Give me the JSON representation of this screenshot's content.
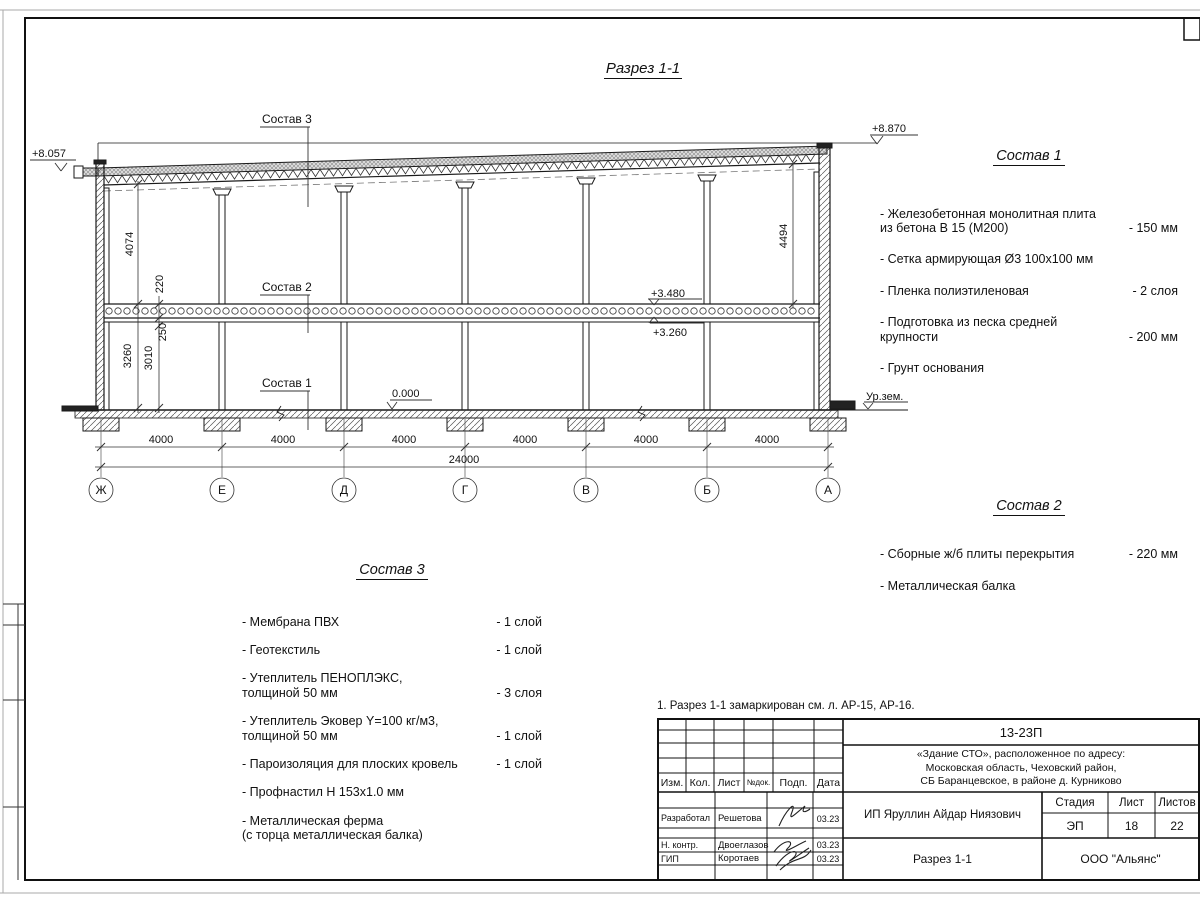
{
  "title": {
    "text": "Разрез 1-1"
  },
  "note": {
    "text": "1. Разрез 1-1 замаркирован см. л. АР-15, АР-16."
  },
  "drawing": {
    "callouts": {
      "c1": "Состав 1",
      "c2": "Состав 2",
      "c3": "Состав 3"
    },
    "elevations": {
      "left_top": "+8.057",
      "right_top": "+8.870",
      "slab_top": "+3.480",
      "slab_bottom": "+3.260",
      "floor": "0.000",
      "ground": "Ур.зем."
    },
    "dims": {
      "bays": [
        "4000",
        "4000",
        "4000",
        "4000",
        "4000",
        "4000"
      ],
      "total": "24000",
      "roof_to_slab_left": "4074",
      "slab_to_floor_left": "3260",
      "slab_thickness": "220",
      "beam_zone": "250",
      "clear_height": "3010",
      "roof_to_slab_right": "4494"
    },
    "axes": [
      "Ж",
      "Е",
      "Д",
      "Г",
      "В",
      "Б",
      "А"
    ]
  },
  "sostav1": {
    "heading": "Состав 1",
    "items": [
      {
        "name": "- Железобетонная  монолитная плита\nиз бетона В 15 (М200)",
        "qty": "- 150 мм"
      },
      {
        "name": "- Сетка армирующая Ø3 100х100 мм",
        "qty": ""
      },
      {
        "name": "- Пленка полиэтиленовая",
        "qty": "-  2 слоя"
      },
      {
        "name": "- Подготовка из песка средней\nкрупности",
        "qty": "- 200 мм"
      },
      {
        "name": "- Грунт основания",
        "qty": ""
      }
    ]
  },
  "sostav2": {
    "heading": "Состав 2",
    "items": [
      {
        "name": "- Сборные ж/б плиты перекрытия",
        "qty": "- 220 мм"
      },
      {
        "name": "- Металлическая  балка",
        "qty": ""
      }
    ]
  },
  "sostav3": {
    "heading": "Состав 3",
    "items": [
      {
        "name": "- Мембрана ПВХ",
        "qty": "- 1 слой"
      },
      {
        "name": "- Геотекстиль",
        "qty": "- 1 слой"
      },
      {
        "name": "- Утеплитель ПЕНОПЛЭКС,\nтолщиной 50 мм",
        "qty": "- 3 слоя"
      },
      {
        "name": "- Утеплитель Эковер Y=100 кг/м3,\nтолщиной 50 мм",
        "qty": "- 1 слой"
      },
      {
        "name": "- Пароизоляция для плоских кровель",
        "qty": "- 1 слой"
      },
      {
        "name": "- Профнастил Н 153х1.0 мм",
        "qty": ""
      },
      {
        "name": "- Металлическая ферма\n(с торца металлическая балка)",
        "qty": ""
      }
    ]
  },
  "titleblock": {
    "doc_number": "13-23П",
    "project": "«Здание СТО», расположенное по адресу:\nМосковская область, Чеховский район,\nСБ Баранцевское, в районе д. Курниково",
    "client": "ИП Яруллин Айдар Ниязович",
    "drawing_name": "Разрез 1-1",
    "company": "ООО \"Альянс\"",
    "cols": {
      "izm": "Изм.",
      "kol": "Кол.",
      "list": "Лист",
      "ndok": "№док.",
      "podp": "Подп.",
      "data": "Дата"
    },
    "stage_label": "Стадия",
    "sheet_label": "Лист",
    "sheets_label": "Листов",
    "stage": "ЭП",
    "sheet": "18",
    "sheets": "22",
    "rows": [
      {
        "role": "Разработал",
        "name": "Решетова",
        "date": "03.23"
      },
      {
        "role": "Н. контр.",
        "name": "Двоеглазов",
        "date": "03.23"
      },
      {
        "role": "ГИП",
        "name": "Коротаев",
        "date": "03.23"
      }
    ]
  },
  "colors": {
    "line": "#1a1a1a",
    "hatch_bg": "#d9d9d9"
  }
}
